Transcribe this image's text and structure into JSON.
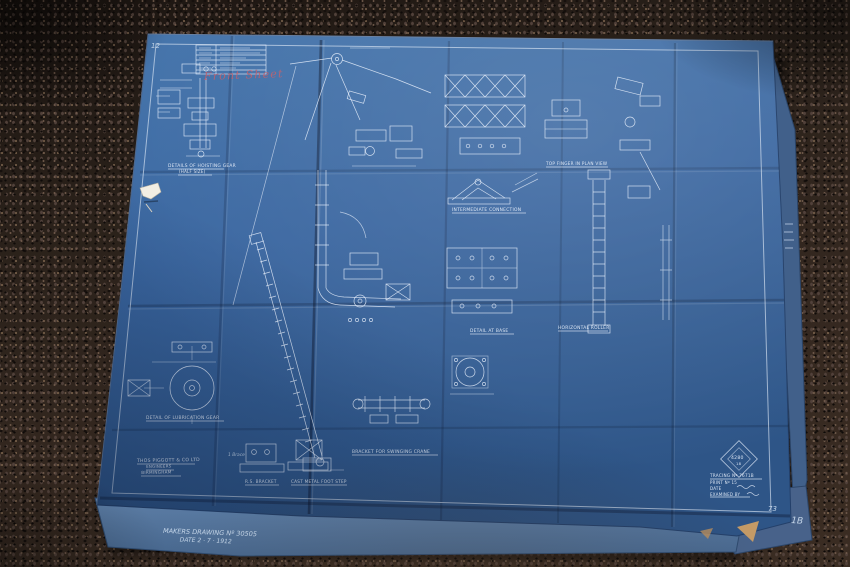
{
  "photo": {
    "subject": "vintage cyanotype engineering blueprint lying on dark speckled carpet",
    "carpet_color": "#2b211c",
    "paper_color": "#3c68a0",
    "ink_color": "#e8f1fb",
    "red_ink_color": "#c05a67"
  },
  "blueprint": {
    "corner_number_top_left": "12",
    "corner_number_bottom_right": "73",
    "under_sheet_number": "1B",
    "red_annotation": "Front Sheet",
    "captions": {
      "details_of_hoisting_gear": "DETAILS OF HOISTING GEAR",
      "details_of_hoisting_gear_sub": "(HALF SIZE)",
      "top_finger": "TOP FINGER IN PLAN VIEW",
      "intermediate_connection": "INTERMEDIATE CONNECTION",
      "detail_at_base": "DETAIL AT BASE",
      "horizontal_roller": "HORIZONTAL ROLLER",
      "detail_of_lubrication_gear": "DETAIL OF LUBRICATION GEAR",
      "bracket_for_swinging_crane": "BRACKET FOR SWINGING CRANE",
      "rs_bracket": "R.S. BRACKET",
      "cast_metal_foot_step": "CAST METAL FOOT STEP",
      "small_note": "1 Brace"
    },
    "maker_block": {
      "line1": "THOS PIGGOTT & CO LTD",
      "line2": "ENGINEERS",
      "line3": "BIRMINGHAM"
    },
    "stamp": {
      "diamond_top": "4280",
      "diamond_bottom": "18",
      "tracing_no": "TRACING Nº 7671B",
      "print_no": "PRINT Nº 15",
      "date_line": "DATE",
      "examined_line": "EXAMINED BY"
    },
    "handwritten_note": {
      "line1": "MAKERS DRAWING Nº 30505",
      "line2": "DATE 2 · 7 · 1912"
    }
  }
}
